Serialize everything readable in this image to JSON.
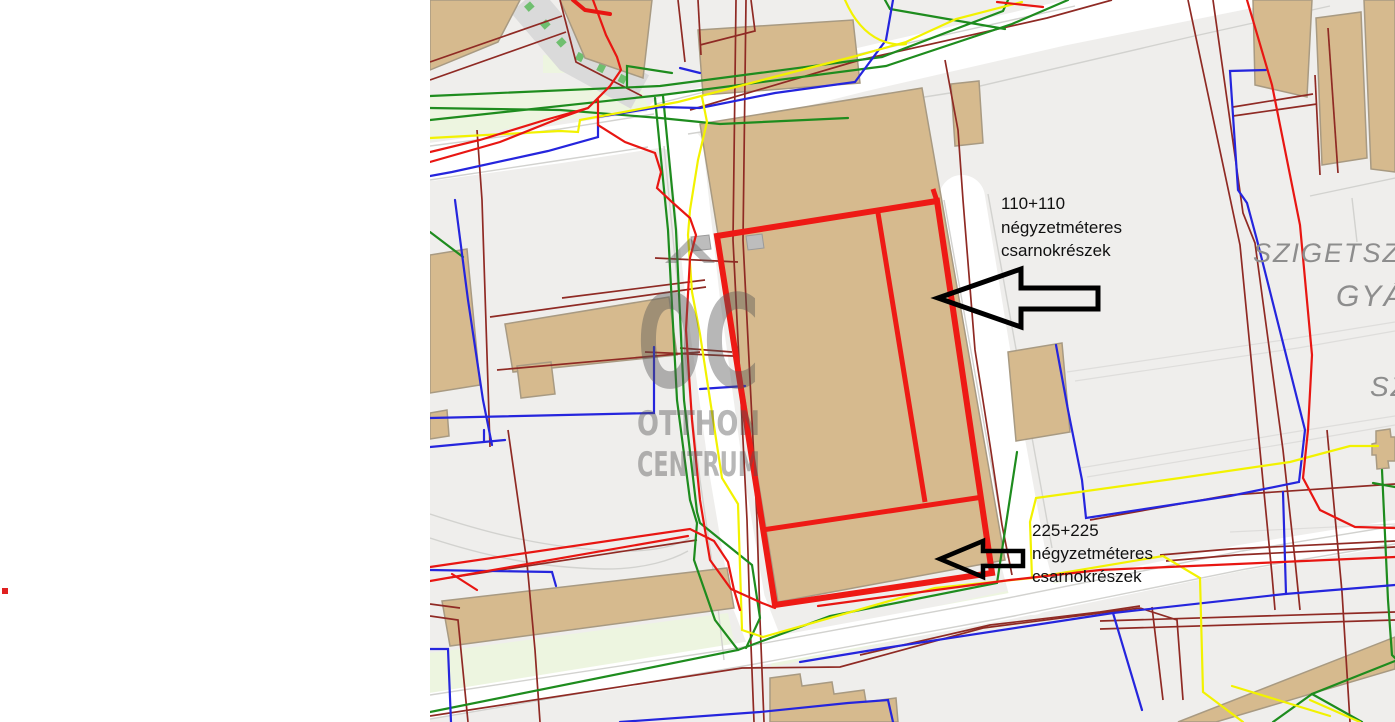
{
  "colors": {
    "map_bg": "#efeeec",
    "road_white": "#ffffff",
    "road_gray": "#dadada",
    "road_dash_green": "#6fbf6f",
    "casing": "#d2d2cf",
    "faint_line": "#dedddb",
    "pale_green": "#edf5e0",
    "building_fill": "#d6ba8e",
    "building_stroke": "#a89a82",
    "gray_block": "#bdbdbd",
    "parcel_red": "#ee1a15",
    "line_red": "#e81612",
    "line_dark_red": "#8f2a24",
    "line_green": "#1e8c1e",
    "line_blue": "#2525dd",
    "line_yellow": "#f2f200",
    "watermark_gray": "#555555",
    "label_gray": "#8d8d8d",
    "annotation_text": "#111111",
    "arrow_black": "#000000",
    "dot_red": "#e02020"
  },
  "map": {
    "watermark": {
      "logo": "OC",
      "line2": "OTTHON",
      "line3": "CENTRUM"
    },
    "area_labels": [
      {
        "text": "SZIGETSZ"
      },
      {
        "text": "GYÁ"
      },
      {
        "text": "SZ"
      }
    ],
    "annotations": [
      {
        "line1": "110+110",
        "line2": "négyzetméteres",
        "line3": "csarnokrészek"
      },
      {
        "line1": "225+225",
        "line2": "négyzetméteres",
        "line3": "csarnokrészek"
      }
    ]
  }
}
